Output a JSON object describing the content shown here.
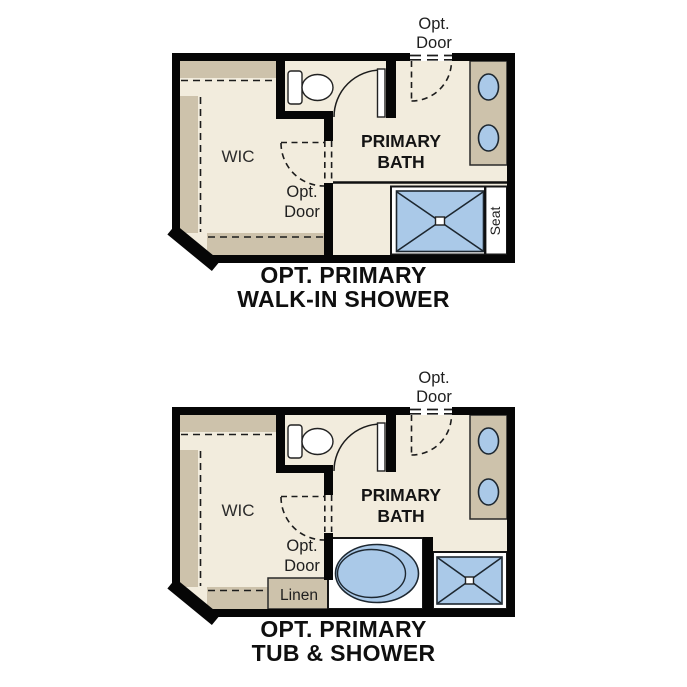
{
  "document": {
    "type": "floor-plan-options-sheet",
    "colors": {
      "floor": "#f2ecdd",
      "cabinetry": "#cdc2ab",
      "fixture_blue": "#aac9e8",
      "wall": "#060606",
      "text": "#1f1f1f",
      "background": "#ffffff"
    }
  },
  "plan_walk_in": {
    "title_line1": "OPT. PRIMARY",
    "title_line2": "WALK-IN SHOWER",
    "labels": {
      "opt_door_top_1": "Opt.",
      "opt_door_top_2": "Door",
      "bath_1": "PRIMARY",
      "bath_2": "BATH",
      "wic": "WIC",
      "opt_door_wic_1": "Opt.",
      "opt_door_wic_2": "Door",
      "seat": "Seat"
    }
  },
  "plan_tub": {
    "title_line1": "OPT. PRIMARY",
    "title_line2": "TUB & SHOWER",
    "labels": {
      "opt_door_top_1": "Opt.",
      "opt_door_top_2": "Door",
      "bath_1": "PRIMARY",
      "bath_2": "BATH",
      "wic": "WIC",
      "opt_door_wic_1": "Opt.",
      "opt_door_wic_2": "Door",
      "linen": "Linen"
    }
  }
}
